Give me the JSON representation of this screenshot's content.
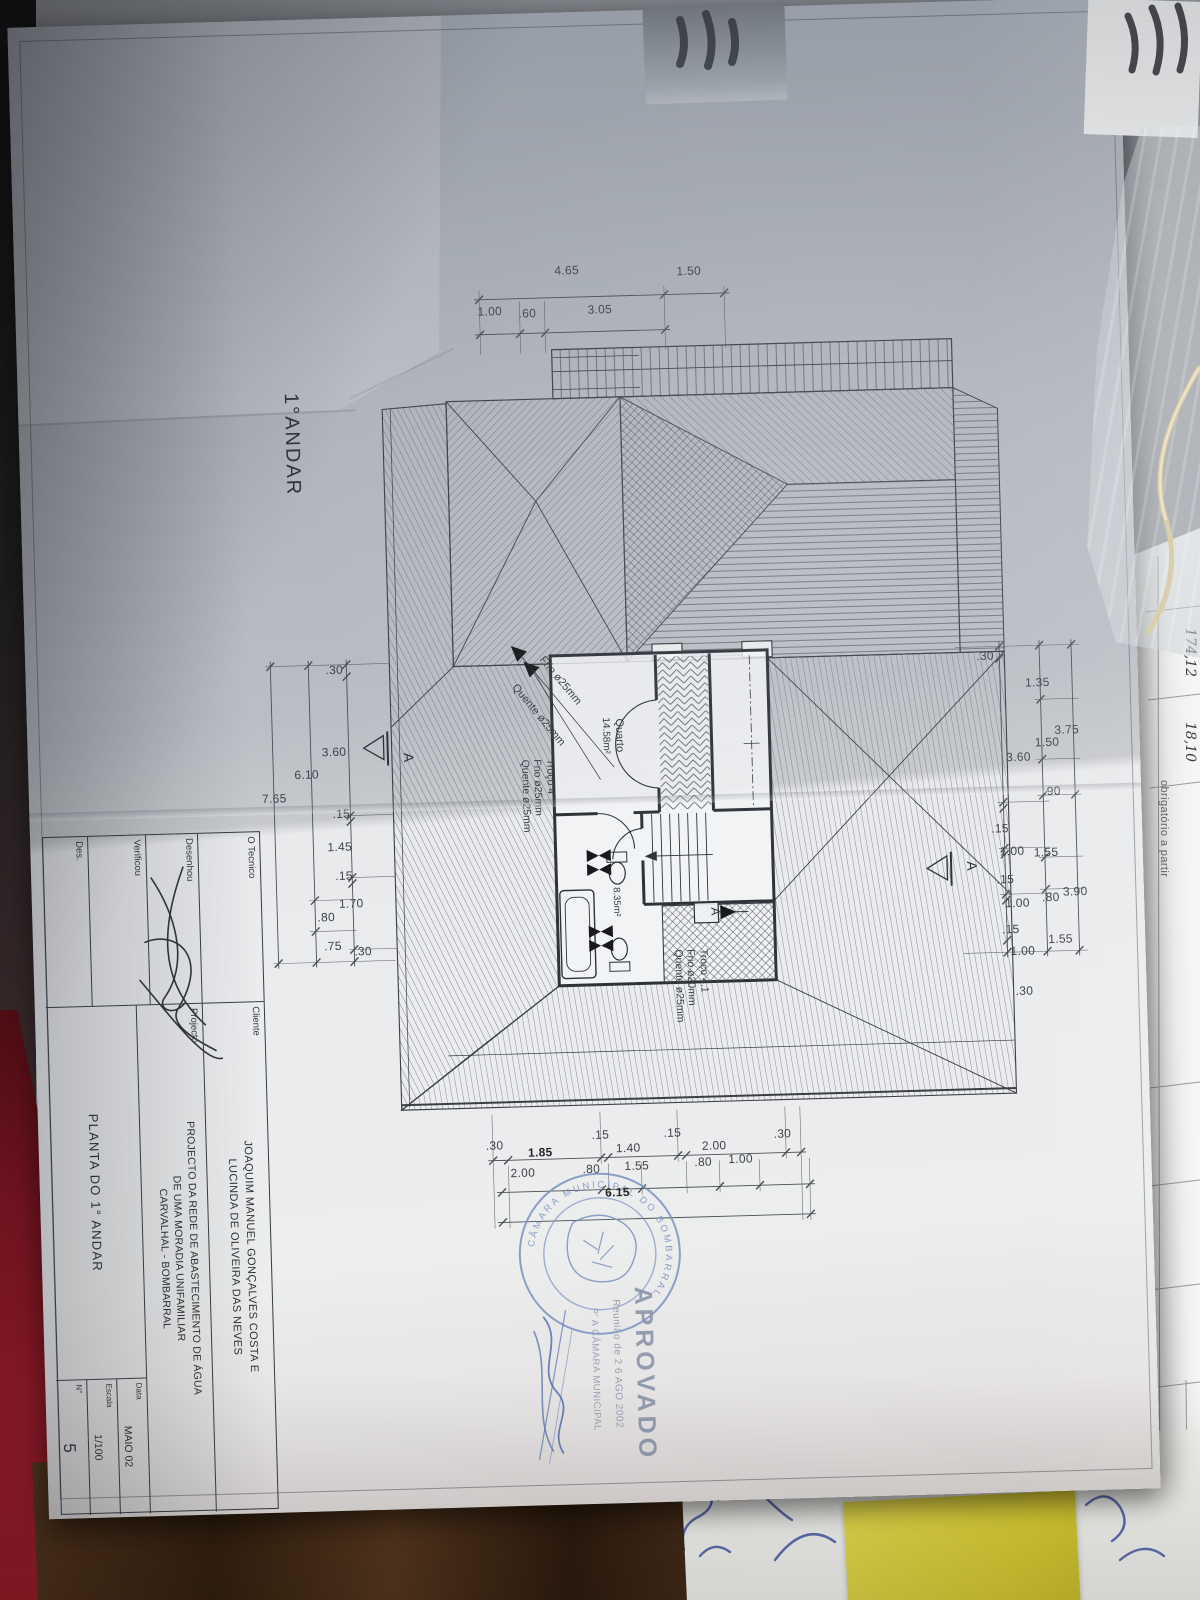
{
  "plan": {
    "floor_title": "1°ANDAR",
    "quarto_name": "Quarto",
    "quarto_area": "14.58m²",
    "is_area": "8.35m²",
    "frio_leader": "Frio ø25mm",
    "quente_leader": "Quente ø25mm",
    "troco4_title": "Troço 4",
    "troco4_frio": "Frio ø25mm",
    "troco4_quente": "Quente ø25mm",
    "troco41_title": "Troço 4.1",
    "troco41_frio": "Frio ø20mm",
    "troco41_quente": "Quente ø25mm",
    "section_letter": "A",
    "detail_letter": "A"
  },
  "dimensions": {
    "top_row1": [
      "4.65",
      "1.50"
    ],
    "top_row2": [
      "1.00",
      ".60",
      "3.05"
    ],
    "left_inner": [
      ".30",
      "3.60",
      ".15",
      "1.45",
      ".15",
      "1.70",
      ".30"
    ],
    "left_mid": [
      "6.10",
      ".80",
      ".75"
    ],
    "left_total": "7.65",
    "right_inner": [
      ".30",
      "3.60",
      ".15",
      "1.00",
      ".15",
      "1.00",
      ".15",
      "1.00",
      ".30"
    ],
    "right_mid": [
      "1.35",
      "1.50",
      ".90",
      "1.55",
      ".80",
      "1.55"
    ],
    "right_outer": [
      "3.75",
      "3.90"
    ],
    "bottom_row1": [
      ".30",
      "1.85",
      ".15",
      "1.40",
      ".15",
      "2.00",
      ".30"
    ],
    "bottom_row2": [
      "2.00",
      ".80",
      "1.55",
      ".80",
      "1.00"
    ],
    "bottom_total": "6.15"
  },
  "title_block": {
    "tecnico_label": "O Tecnico",
    "desenhou_label": "Desenhou",
    "verificou_label": "Verificou",
    "des_label": "Des.",
    "cliente_label": "Cliente",
    "cliente_line1": "JOAQUIM MANUEL GONÇALVES COSTA E",
    "cliente_line2": "LUCINDA DE OLIVEIRA DAS NEVES",
    "projecto_label": "Projecto",
    "projecto_line1": "PROJECTO DA REDE DE ABASTECIMENTO DE ÁGUA",
    "projecto_line2": "DE UMA MORADIA UNIFAMILIAR",
    "projecto_line3": "CARVALHAL - BOMBARRAL",
    "drawing_title": "PLANTA DO 1° ANDAR",
    "data_label": "Data",
    "data_value": "MAIO 02",
    "escala_label": "Escala",
    "escala_value": "1/100",
    "numero_label": "N°",
    "numero_value": "5"
  },
  "stamp": {
    "approved": "APROVADO",
    "meeting": "Reunião de 2 6 AGO 2002",
    "authority": "P' A CÂMARA MUNICIPAL",
    "seal": "CÂMARA MUNICIPAL DO BOMBARRAL",
    "color": "#7b92c0"
  },
  "side_sheet": {
    "value1": "174,12",
    "value2": "18,10",
    "value3": "2,35",
    "printed": "obrigatório a partir"
  }
}
